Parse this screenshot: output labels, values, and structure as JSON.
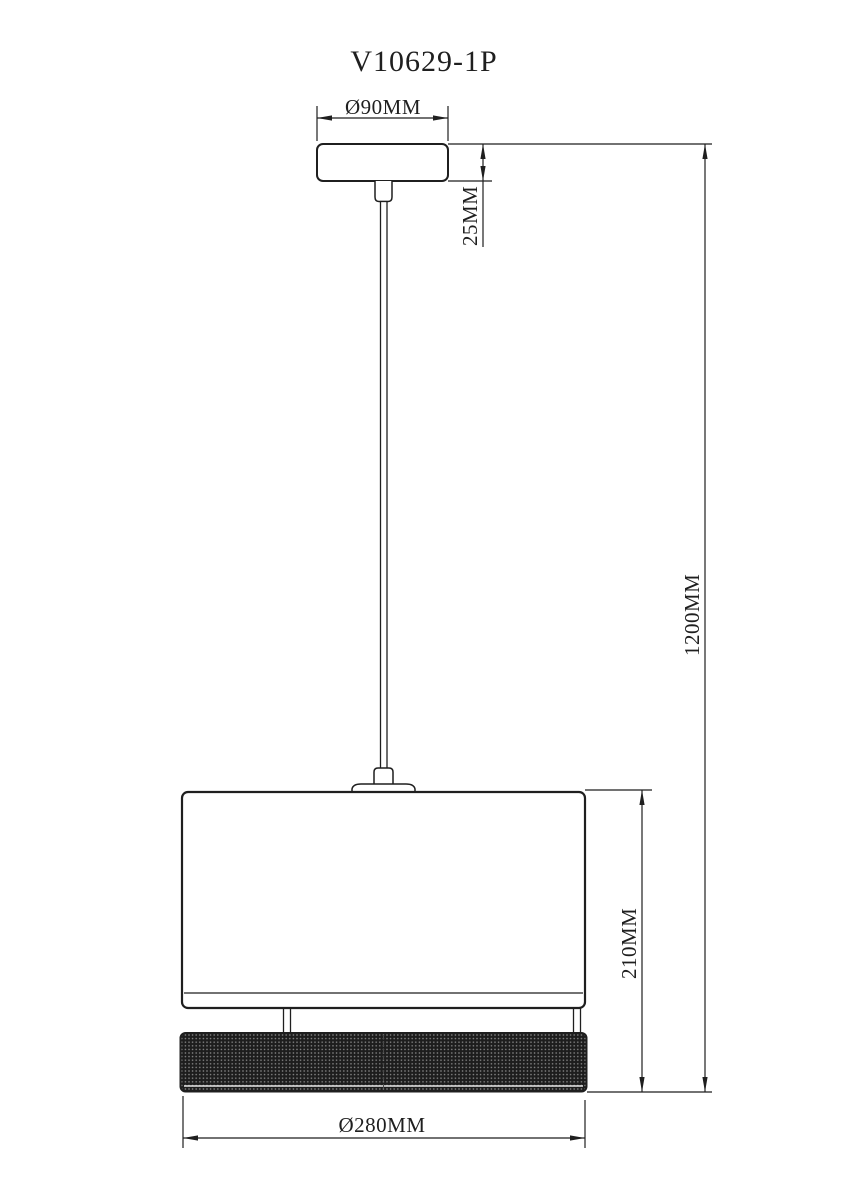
{
  "title": "V10629-1P",
  "dimensions": {
    "canopy_diameter": {
      "label": "Ø90MM",
      "value_mm": 90
    },
    "canopy_height": {
      "label": "25MM",
      "value_mm": 25
    },
    "overall_height": {
      "label": "1200MM",
      "value_mm": 1200
    },
    "shade_height": {
      "label": "210MM",
      "value_mm": 210
    },
    "shade_diameter": {
      "label": "Ø280MM",
      "value_mm": 280
    }
  },
  "colors": {
    "line": "#1f1f1f",
    "background": "#ffffff",
    "mesh_base": "#1d1d1d",
    "mesh_dot": "#8a8a8a",
    "mesh_highlight": "#e8e8e8"
  }
}
